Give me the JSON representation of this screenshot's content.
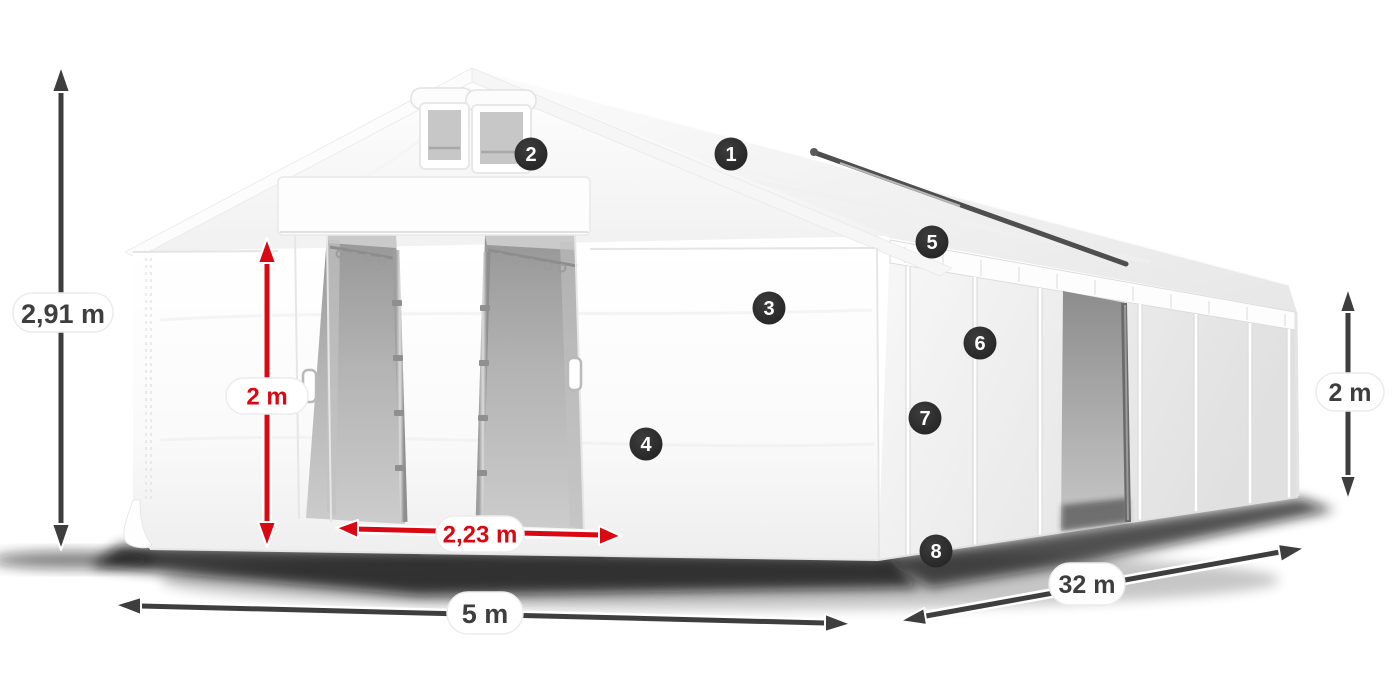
{
  "illustration": {
    "description": "white storage tent with dimension arrows and numbered feature callouts",
    "background": "#ffffff"
  },
  "colors": {
    "accent_red": "#da0812",
    "arrow_dark": "#3e3e3e",
    "badge_background": "#2b2b2b",
    "badge_number": "#ffffff",
    "label_pill_background": "#ffffff",
    "label_text_dark": "#3e3e3e",
    "tent_fabric": "#ffffff",
    "interior_gray": "#b3b3b3"
  },
  "dimension_labels": {
    "total_height": "2,91 m",
    "entrance_height": "2 m",
    "entrance_width": "2,23 m",
    "tent_width": "5 m",
    "tent_length": "32 m",
    "side_wall_height": "2 m"
  },
  "feature_badges": [
    {
      "number": "1"
    },
    {
      "number": "2"
    },
    {
      "number": "3"
    },
    {
      "number": "4"
    },
    {
      "number": "5"
    },
    {
      "number": "6"
    },
    {
      "number": "7"
    },
    {
      "number": "8"
    }
  ]
}
